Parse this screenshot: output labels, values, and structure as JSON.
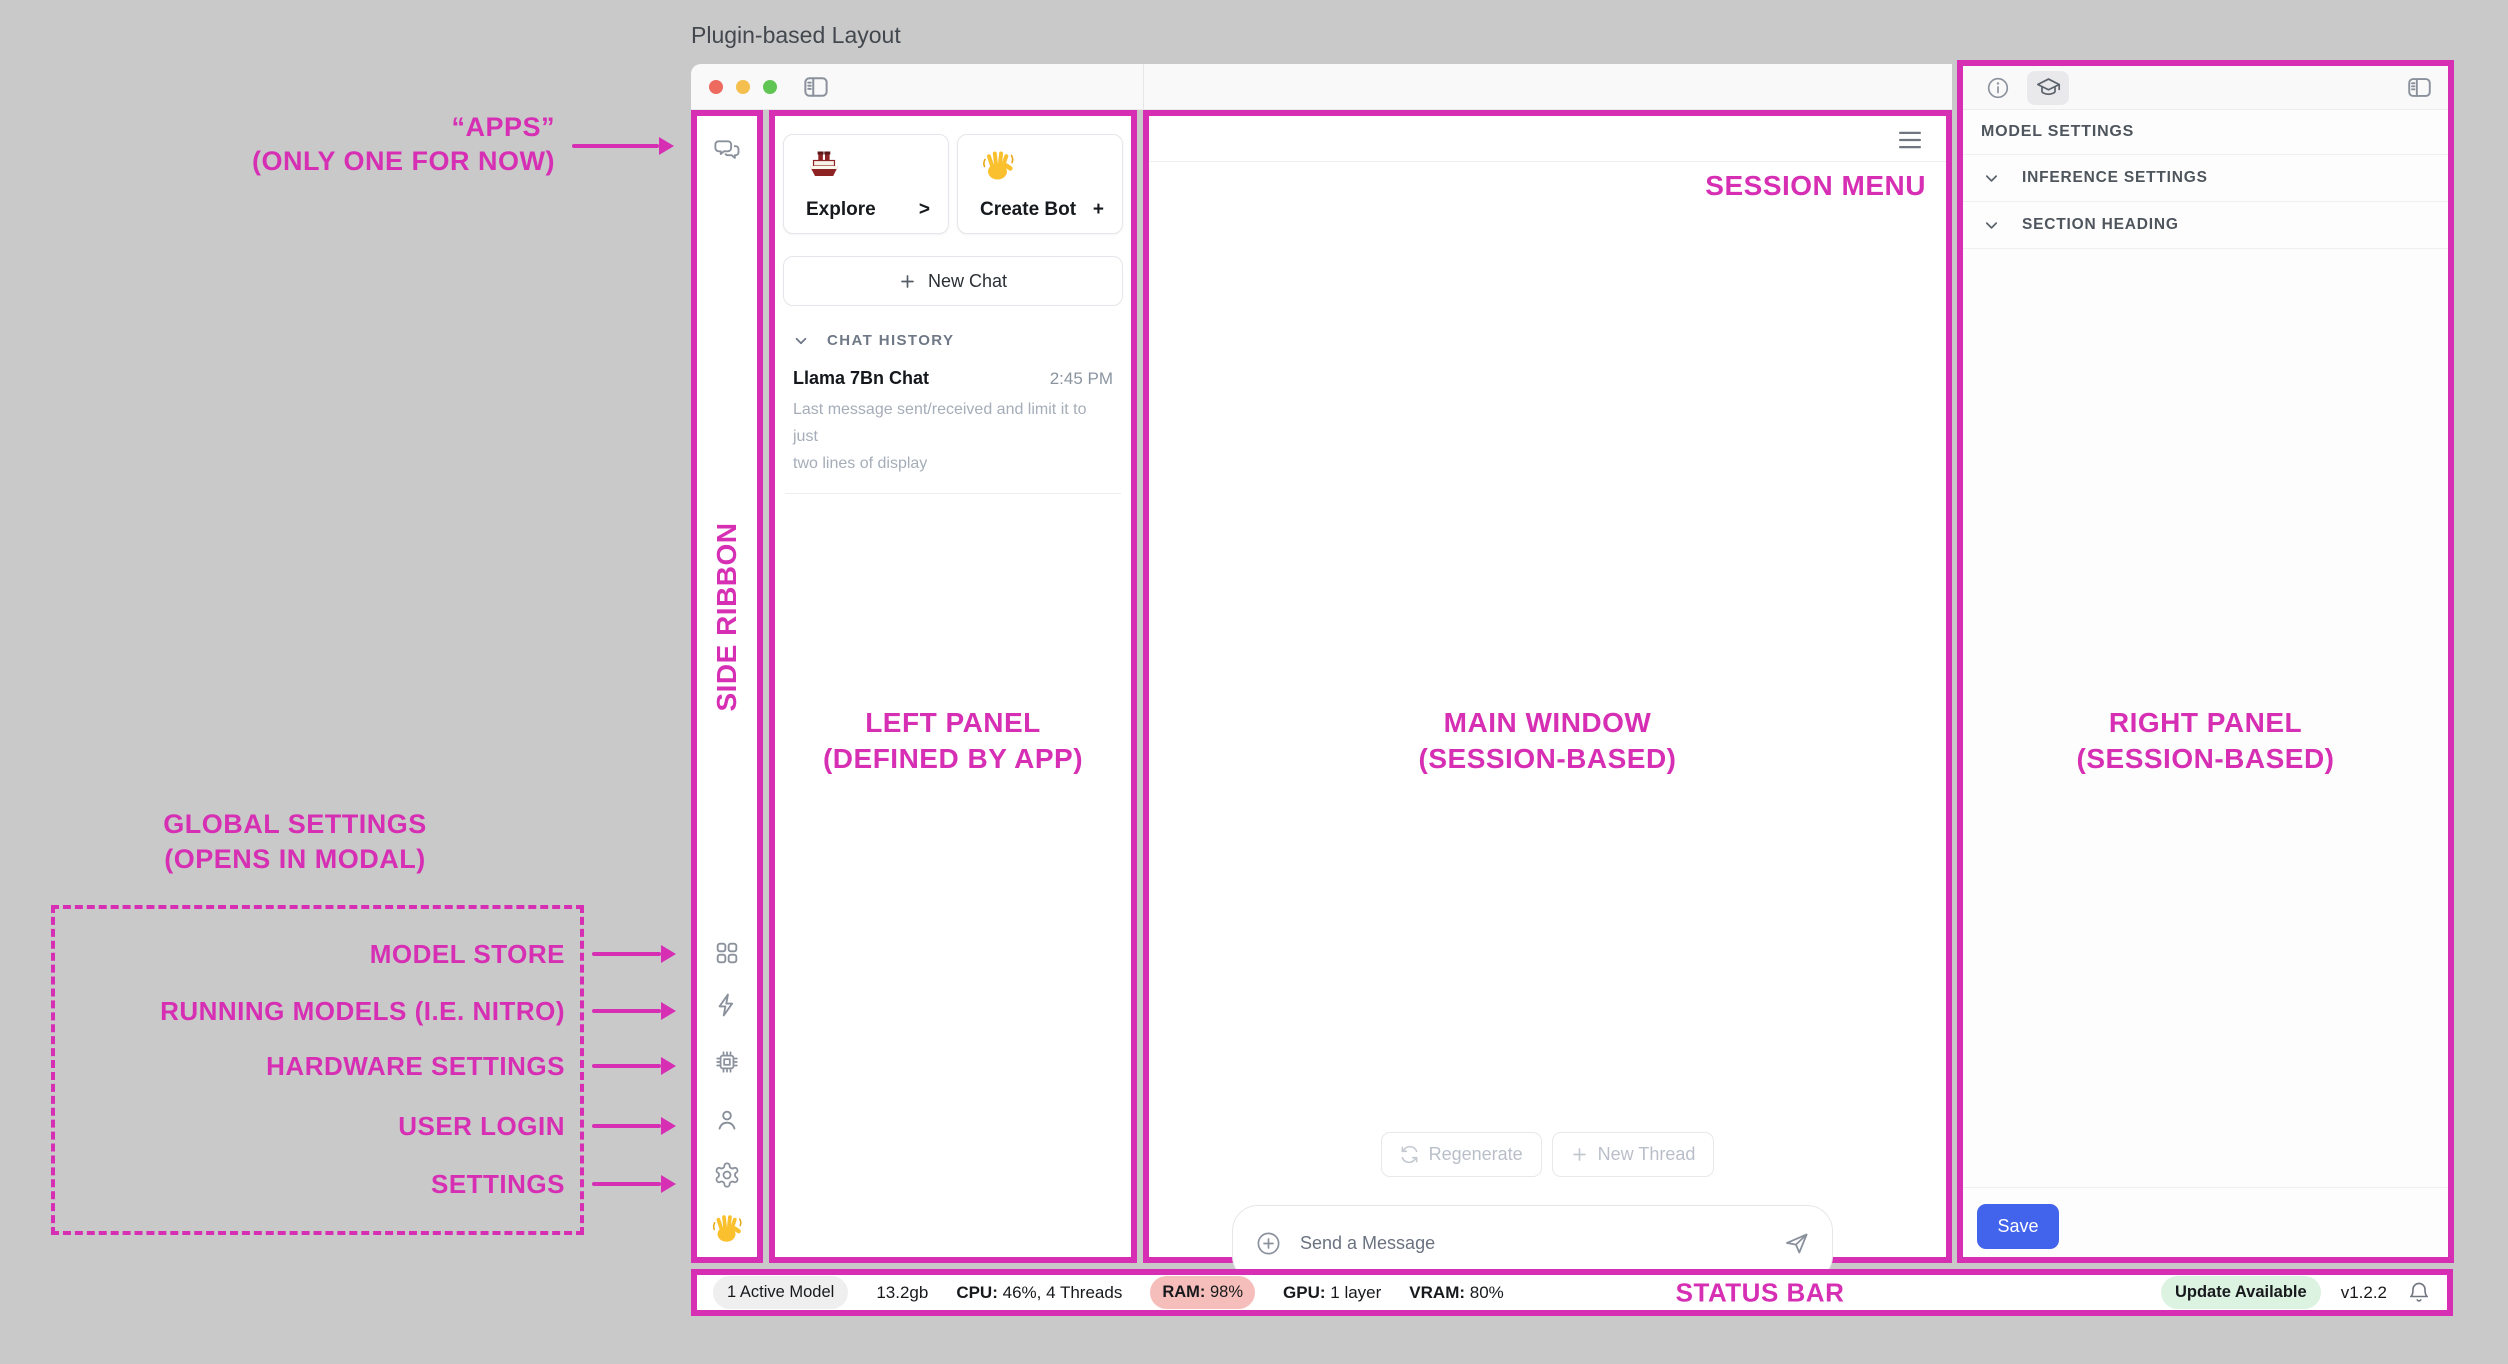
{
  "theme": {
    "pink": "#D62FB4",
    "blue": "#4263EB",
    "ram_bg": "#F6BEBB",
    "update_bg": "#DCF3E2",
    "pill_bg": "#EFEFF0"
  },
  "page": {
    "title": "Plugin-based Layout"
  },
  "icons": {
    "ribbon_top": [
      "chat-bubbles"
    ],
    "ribbon_bottom": [
      "grid",
      "lightning-bolt",
      "cpu-chip",
      "person",
      "gear",
      "waving-hand"
    ],
    "titlebar": [
      "traffic-lights",
      "sidebar-toggle"
    ],
    "right_header": [
      "info-circle",
      "graduation-cap",
      "sidebar-toggle"
    ],
    "composer": [
      "plus-circle",
      "paper-plane"
    ],
    "status": [
      "bell"
    ]
  },
  "annotations": {
    "apps": {
      "line1": "“APPS”",
      "line2": "(ONLY ONE FOR NOW)"
    },
    "side_ribbon": "SIDE RIBBON",
    "left_panel": {
      "line1": "LEFT PANEL",
      "line2": "(DEFINED BY APP)"
    },
    "main_window": {
      "line1": "MAIN WINDOW",
      "line2": "(SESSION-BASED)"
    },
    "right_panel": {
      "line1": "RIGHT PANEL",
      "line2": "(SESSION-BASED)"
    },
    "session_menu": "SESSION MENU",
    "status_bar": "STATUS BAR",
    "global_settings": {
      "line1": "GLOBAL SETTINGS",
      "line2": "(OPENS IN MODAL)"
    },
    "ribbon_targets": [
      "MODEL STORE",
      "RUNNING MODELS (I.E. NITRO)",
      "HARDWARE SETTINGS",
      "USER LOGIN",
      "SETTINGS"
    ]
  },
  "left_panel": {
    "cards": [
      {
        "emoji": "ship",
        "label": "Explore",
        "action": ">"
      },
      {
        "emoji": "waving-hand",
        "label": "Create Bot",
        "action": "+"
      }
    ],
    "new_chat": "New Chat",
    "history": {
      "heading": "CHAT HISTORY",
      "items": [
        {
          "title": "Llama 7Bn Chat",
          "time": "2:45 PM",
          "preview_line1": "Last message sent/received and limit it to just",
          "preview_line2": "two lines of display"
        }
      ]
    }
  },
  "main": {
    "regenerate": "Regenerate",
    "new_thread": "New Thread",
    "composer_placeholder": "Send a Message"
  },
  "right_panel": {
    "heading": "MODEL SETTINGS",
    "sections": [
      "INFERENCE SETTINGS",
      "SECTION HEADING"
    ],
    "save": "Save"
  },
  "status_bar": {
    "active_models": "1 Active Model",
    "memory": "13.2gb",
    "cpu_label": "CPU:",
    "cpu_value": "46%, 4 Threads",
    "ram_label": "RAM:",
    "ram_value": "98%",
    "gpu_label": "GPU:",
    "gpu_value": "1 layer",
    "vram_label": "VRAM:",
    "vram_value": "80%",
    "update": "Update Available",
    "version": "v1.2.2"
  }
}
